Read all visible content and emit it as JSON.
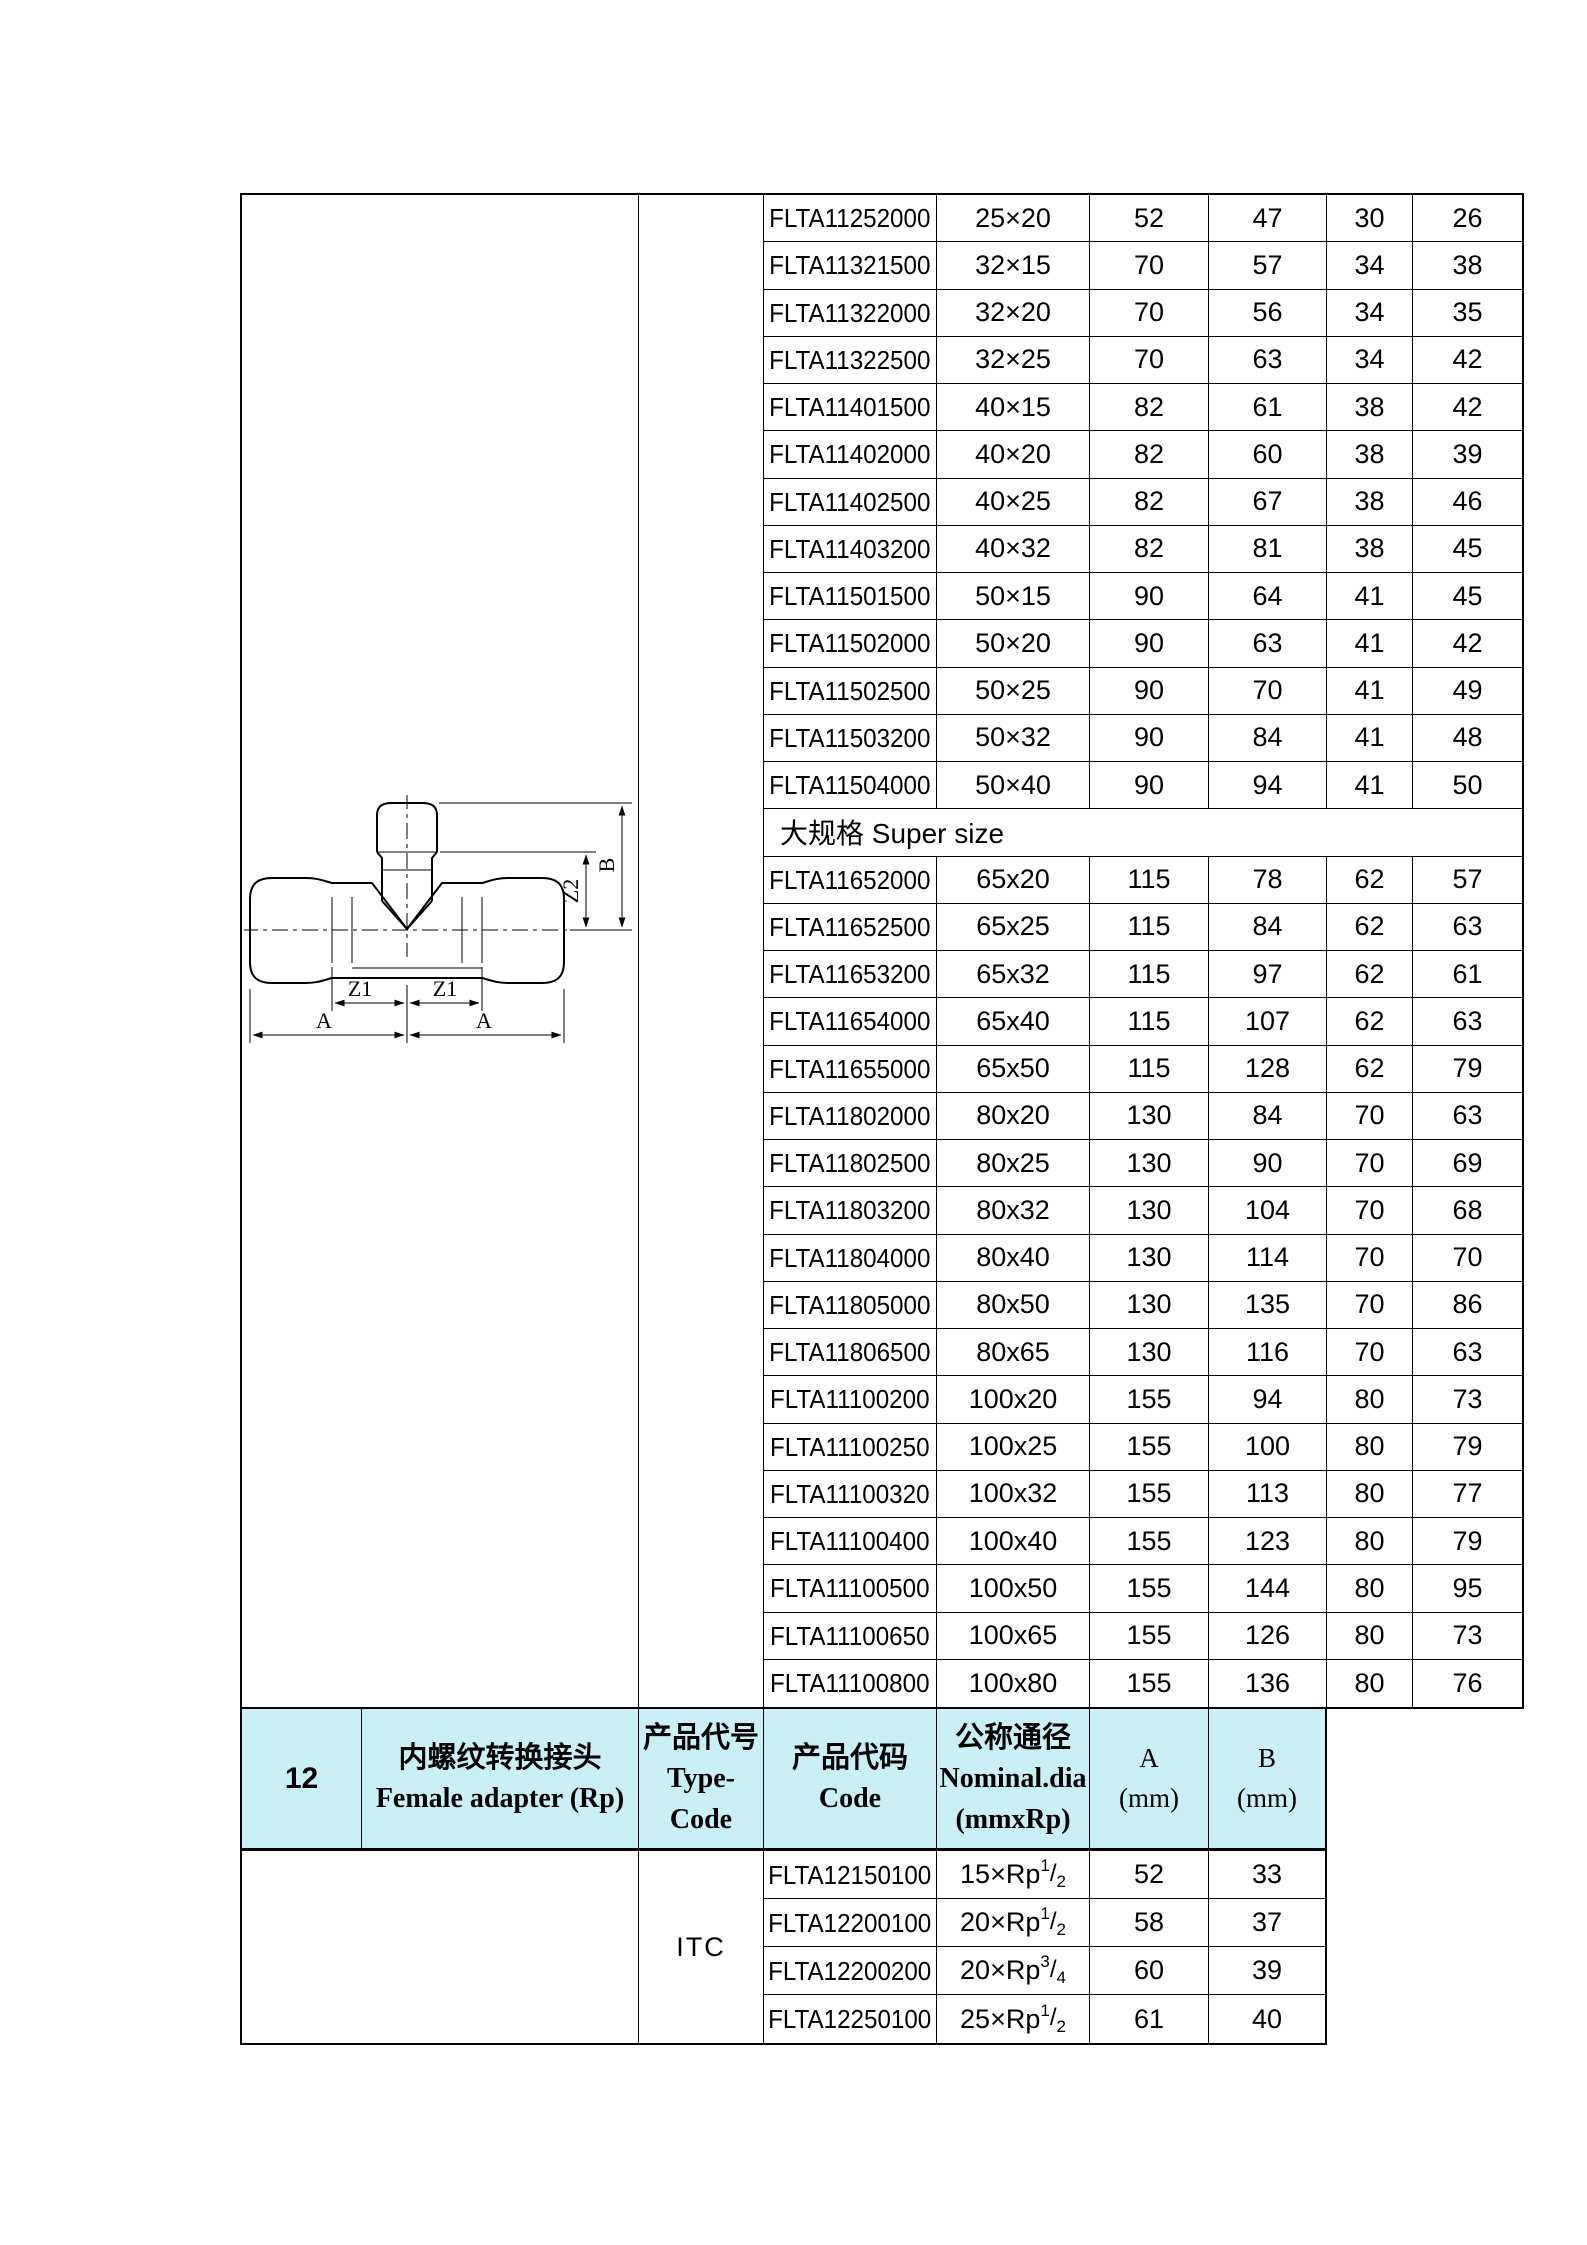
{
  "colors": {
    "header_bg": "#c9f0f5",
    "border": "#000000",
    "text": "#000000",
    "page_bg": "#ffffff"
  },
  "drawing": {
    "a_label": "A",
    "z1_label": "Z1",
    "z2_label": "Z2",
    "b_label": "B"
  },
  "top_table": {
    "standard_rows": [
      {
        "code": "FLTA11252000",
        "size": "25×20",
        "a": "52",
        "b": "47",
        "z1": "30",
        "z2": "26"
      },
      {
        "code": "FLTA11321500",
        "size": "32×15",
        "a": "70",
        "b": "57",
        "z1": "34",
        "z2": "38"
      },
      {
        "code": "FLTA11322000",
        "size": "32×20",
        "a": "70",
        "b": "56",
        "z1": "34",
        "z2": "35"
      },
      {
        "code": "FLTA11322500",
        "size": "32×25",
        "a": "70",
        "b": "63",
        "z1": "34",
        "z2": "42"
      },
      {
        "code": "FLTA11401500",
        "size": "40×15",
        "a": "82",
        "b": "61",
        "z1": "38",
        "z2": "42"
      },
      {
        "code": "FLTA11402000",
        "size": "40×20",
        "a": "82",
        "b": "60",
        "z1": "38",
        "z2": "39"
      },
      {
        "code": "FLTA11402500",
        "size": "40×25",
        "a": "82",
        "b": "67",
        "z1": "38",
        "z2": "46"
      },
      {
        "code": "FLTA11403200",
        "size": "40×32",
        "a": "82",
        "b": "81",
        "z1": "38",
        "z2": "45"
      },
      {
        "code": "FLTA11501500",
        "size": "50×15",
        "a": "90",
        "b": "64",
        "z1": "41",
        "z2": "45"
      },
      {
        "code": "FLTA11502000",
        "size": "50×20",
        "a": "90",
        "b": "63",
        "z1": "41",
        "z2": "42"
      },
      {
        "code": "FLTA11502500",
        "size": "50×25",
        "a": "90",
        "b": "70",
        "z1": "41",
        "z2": "49"
      },
      {
        "code": "FLTA11503200",
        "size": "50×32",
        "a": "90",
        "b": "84",
        "z1": "41",
        "z2": "48"
      },
      {
        "code": "FLTA11504000",
        "size": "50×40",
        "a": "90",
        "b": "94",
        "z1": "41",
        "z2": "50"
      }
    ],
    "section_label": "大规格 Super size",
    "super_rows": [
      {
        "code": "FLTA11652000",
        "size": "65x20",
        "a": "115",
        "b": "78",
        "z1": "62",
        "z2": "57"
      },
      {
        "code": "FLTA11652500",
        "size": "65x25",
        "a": "115",
        "b": "84",
        "z1": "62",
        "z2": "63"
      },
      {
        "code": "FLTA11653200",
        "size": "65x32",
        "a": "115",
        "b": "97",
        "z1": "62",
        "z2": "61"
      },
      {
        "code": "FLTA11654000",
        "size": "65x40",
        "a": "115",
        "b": "107",
        "z1": "62",
        "z2": "63"
      },
      {
        "code": "FLTA11655000",
        "size": "65x50",
        "a": "115",
        "b": "128",
        "z1": "62",
        "z2": "79"
      },
      {
        "code": "FLTA11802000",
        "size": "80x20",
        "a": "130",
        "b": "84",
        "z1": "70",
        "z2": "63"
      },
      {
        "code": "FLTA11802500",
        "size": "80x25",
        "a": "130",
        "b": "90",
        "z1": "70",
        "z2": "69"
      },
      {
        "code": "FLTA11803200",
        "size": "80x32",
        "a": "130",
        "b": "104",
        "z1": "70",
        "z2": "68"
      },
      {
        "code": "FLTA11804000",
        "size": "80x40",
        "a": "130",
        "b": "114",
        "z1": "70",
        "z2": "70"
      },
      {
        "code": "FLTA11805000",
        "size": "80x50",
        "a": "130",
        "b": "135",
        "z1": "70",
        "z2": "86"
      },
      {
        "code": "FLTA11806500",
        "size": "80x65",
        "a": "130",
        "b": "116",
        "z1": "70",
        "z2": "63"
      },
      {
        "code": "FLTA11100200",
        "size": "100x20",
        "a": "155",
        "b": "94",
        "z1": "80",
        "z2": "73"
      },
      {
        "code": "FLTA11100250",
        "size": "100x25",
        "a": "155",
        "b": "100",
        "z1": "80",
        "z2": "79"
      },
      {
        "code": "FLTA11100320",
        "size": "100x32",
        "a": "155",
        "b": "113",
        "z1": "80",
        "z2": "77"
      },
      {
        "code": "FLTA11100400",
        "size": "100x40",
        "a": "155",
        "b": "123",
        "z1": "80",
        "z2": "79"
      },
      {
        "code": "FLTA11100500",
        "size": "100x50",
        "a": "155",
        "b": "144",
        "z1": "80",
        "z2": "95"
      },
      {
        "code": "FLTA11100650",
        "size": "100x65",
        "a": "155",
        "b": "126",
        "z1": "80",
        "z2": "73"
      },
      {
        "code": "FLTA11100800",
        "size": "100x80",
        "a": "155",
        "b": "136",
        "z1": "80",
        "z2": "76"
      }
    ]
  },
  "bottom_section": {
    "index": "12",
    "name_cn": "内螺纹转换接头",
    "name_en": "Female adapter (Rp)",
    "type_code_cn": "产品代号",
    "type_code_en": "Type-Code",
    "code_cn": "产品代码",
    "code_en": "Code",
    "nominal_cn": "公称通径",
    "nominal_en": "Nominal.dia",
    "nominal_unit": "(mmxRp)",
    "col_a": "A",
    "col_a_unit": "(mm)",
    "col_b": "B",
    "col_b_unit": "(mm)",
    "type_code_value": "ITC",
    "fraction_slash": "/",
    "rows": [
      {
        "code": "FLTA12150100",
        "size_base": "15×Rp",
        "size_sup": "1",
        "size_sub": "2",
        "a": "52",
        "b": "33"
      },
      {
        "code": "FLTA12200100",
        "size_base": "20×Rp",
        "size_sup": "1",
        "size_sub": "2",
        "a": "58",
        "b": "37"
      },
      {
        "code": "FLTA12200200",
        "size_base": "20×Rp",
        "size_sup": "3",
        "size_sub": "4",
        "a": "60",
        "b": "39"
      },
      {
        "code": "FLTA12250100",
        "size_base": "25×Rp",
        "size_sup": "1",
        "size_sub": "2",
        "a": "61",
        "b": "40"
      }
    ]
  }
}
